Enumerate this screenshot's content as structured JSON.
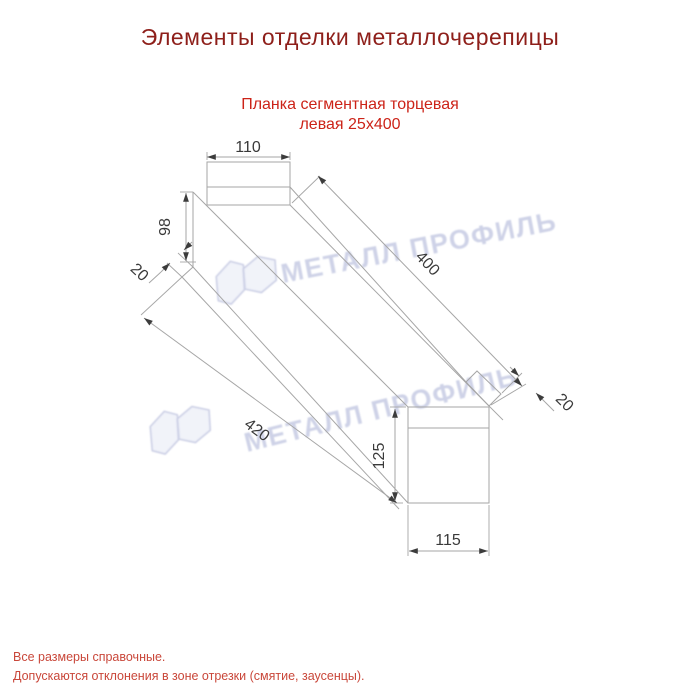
{
  "page": {
    "title": "Элементы отделки металлочерепицы"
  },
  "product": {
    "subtitle_line1": "Планка сегментная торцевая",
    "subtitle_line2": "левая 25х400"
  },
  "drawing": {
    "type": "technical-dimension-drawing",
    "dims": {
      "top_width": "110",
      "left_height": "98",
      "left_hem": "20",
      "length_top": "400",
      "length_bottom": "420",
      "right_height": "125",
      "bottom_width": "115",
      "right_hem": "20"
    }
  },
  "watermark": {
    "text": "МЕТАЛЛ ПРОФИЛЬ"
  },
  "footer": {
    "line1": "Все размеры справочные.",
    "line2": "Допускаются отклонения в зоне отрезки (смятие, заусенцы)."
  },
  "colors": {
    "background": "#ffffff",
    "title": "#8e1f1a",
    "subtitle": "#cc2318",
    "footer": "#c9473a",
    "drawing_line": "#a6a6a6",
    "arrow": "#3c3c3c",
    "dim_text": "#3a3a3a",
    "watermark": "#ccd0e6"
  }
}
